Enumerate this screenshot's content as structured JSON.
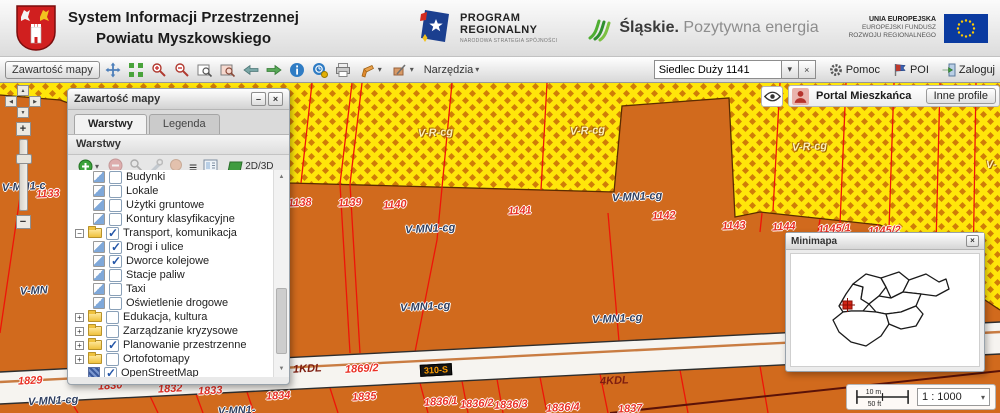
{
  "header": {
    "title_line1": "System Informacji Przestrzennej",
    "title_line2": "Powiatu Myszkowskiego",
    "program_logo": {
      "line1": "PROGRAM",
      "line2": "REGIONALNY",
      "subtitle": "NARODOWA STRATEGIA SPÓJNOŚCI"
    },
    "slaskie_logo": {
      "name": "Śląskie.",
      "tagline": "Pozytywna energia"
    },
    "eu_logo": {
      "line1": "UNIA EUROPEJSKA",
      "line2": "EUROPEJSKI FUNDUSZ",
      "line3": "ROZWOJU REGIONALNEGO"
    }
  },
  "toolbar": {
    "content_button": "Zawartość mapy",
    "tools_menu": "Narzędzia",
    "search_value": "Siedlec Duży 1141",
    "help_label": "Pomoc",
    "poi_label": "POI",
    "login_label": "Zaloguj"
  },
  "layers_panel": {
    "title": "Zawartość mapy",
    "tab_layers": "Warstwy",
    "tab_legend": "Legenda",
    "section_title": "Warstwy",
    "mode_label": "2D/3D",
    "tree": [
      {
        "label": "Budynki",
        "type": "layer",
        "checked": false,
        "indent": 1
      },
      {
        "label": "Lokale",
        "type": "layer",
        "checked": false,
        "indent": 1
      },
      {
        "label": "Użytki gruntowe",
        "type": "layer",
        "checked": false,
        "indent": 1
      },
      {
        "label": "Kontury klasyfikacyjne",
        "type": "layer",
        "checked": false,
        "indent": 1
      },
      {
        "label": "Transport, komunikacja",
        "type": "folder",
        "checked": true,
        "expanded": true,
        "indent": 0
      },
      {
        "label": "Drogi i ulice",
        "type": "layer",
        "checked": true,
        "indent": 1
      },
      {
        "label": "Dworce kolejowe",
        "type": "layer",
        "checked": true,
        "indent": 1
      },
      {
        "label": "Stacje paliw",
        "type": "layer",
        "checked": false,
        "indent": 1
      },
      {
        "label": "Taxi",
        "type": "layer",
        "checked": false,
        "indent": 1
      },
      {
        "label": "Oświetlenie drogowe",
        "type": "layer",
        "checked": false,
        "indent": 1
      },
      {
        "label": "Edukacja, kultura",
        "type": "folder",
        "checked": false,
        "expanded": false,
        "indent": 0
      },
      {
        "label": "Zarządzanie kryzysowe",
        "type": "folder",
        "checked": false,
        "expanded": false,
        "indent": 0
      },
      {
        "label": "Planowanie przestrzenne",
        "type": "folder",
        "checked": true,
        "expanded": false,
        "indent": 0
      },
      {
        "label": "Ortofotomapy",
        "type": "folder",
        "checked": false,
        "expanded": false,
        "indent": 0
      },
      {
        "label": "OpenStreetMap",
        "type": "osm",
        "checked": true,
        "indent": 0
      }
    ]
  },
  "profile_bar": {
    "portal": "Portal Mieszkańca",
    "other_profiles": "Inne profile"
  },
  "minimap": {
    "title": "Minimapa"
  },
  "scale": {
    "bar_m": "10 m",
    "bar_ft": "50 ft",
    "ratio": "1 : 1000"
  },
  "map": {
    "labels": [
      {
        "text": "V-R-cg",
        "x": 418,
        "y": 44,
        "cls": "zone-light"
      },
      {
        "text": "V-R-cg",
        "x": 570,
        "y": 42,
        "cls": "zone-light"
      },
      {
        "text": "V-R-cg",
        "x": 792,
        "y": 58,
        "cls": "zone-light"
      },
      {
        "text": "V-",
        "x": 986,
        "y": 76,
        "cls": "zone-light"
      },
      {
        "text": "V-MN1-cg",
        "x": 405,
        "y": 140,
        "cls": "zone-dark"
      },
      {
        "text": "V-MN1-cg",
        "x": 612,
        "y": 108,
        "cls": "zone-dark"
      },
      {
        "text": "V-MN1-cg",
        "x": 400,
        "y": 218,
        "cls": "zone-dark"
      },
      {
        "text": "V-MN1-cg",
        "x": 592,
        "y": 230,
        "cls": "zone-dark"
      },
      {
        "text": "V-MN1-cg",
        "x": 28,
        "y": 312,
        "cls": "zone-dark"
      },
      {
        "text": "V-MN1-c",
        "x": 2,
        "y": 98,
        "cls": "zone-dark"
      },
      {
        "text": "V-MN",
        "x": 20,
        "y": 202,
        "cls": "zone-dark"
      },
      {
        "text": "V-MN1-",
        "x": 218,
        "y": 322,
        "cls": "zone-dark"
      },
      {
        "text": "1133",
        "x": 36,
        "y": 105,
        "cls": "parcel"
      },
      {
        "text": "1138",
        "x": 288,
        "y": 114,
        "cls": "parcel"
      },
      {
        "text": "1139",
        "x": 338,
        "y": 114,
        "cls": "parcel"
      },
      {
        "text": "1140",
        "x": 383,
        "y": 116,
        "cls": "parcel"
      },
      {
        "text": "1141",
        "x": 508,
        "y": 122,
        "cls": "parcel"
      },
      {
        "text": "1142",
        "x": 652,
        "y": 127,
        "cls": "parcel"
      },
      {
        "text": "1143",
        "x": 722,
        "y": 137,
        "cls": "parcel"
      },
      {
        "text": "1144",
        "x": 772,
        "y": 138,
        "cls": "parcel"
      },
      {
        "text": "1145/1",
        "x": 818,
        "y": 140,
        "cls": "parcel"
      },
      {
        "text": "1145/2",
        "x": 868,
        "y": 142,
        "cls": "parcel"
      },
      {
        "text": "1829",
        "x": 18,
        "y": 292,
        "cls": "parcel"
      },
      {
        "text": "1830",
        "x": 98,
        "y": 297,
        "cls": "parcel"
      },
      {
        "text": "1832",
        "x": 158,
        "y": 300,
        "cls": "parcel"
      },
      {
        "text": "1833",
        "x": 198,
        "y": 302,
        "cls": "parcel"
      },
      {
        "text": "1834",
        "x": 266,
        "y": 307,
        "cls": "parcel"
      },
      {
        "text": "1835",
        "x": 352,
        "y": 308,
        "cls": "parcel"
      },
      {
        "text": "1836/1",
        "x": 424,
        "y": 313,
        "cls": "parcel"
      },
      {
        "text": "1836/2",
        "x": 460,
        "y": 315,
        "cls": "parcel"
      },
      {
        "text": "1836/3",
        "x": 494,
        "y": 316,
        "cls": "parcel"
      },
      {
        "text": "1836/4",
        "x": 546,
        "y": 319,
        "cls": "parcel"
      },
      {
        "text": "1837",
        "x": 618,
        "y": 320,
        "cls": "parcel"
      },
      {
        "text": "1869/2",
        "x": 345,
        "y": 280,
        "cls": "parcel"
      },
      {
        "text": "1KDL",
        "x": 293,
        "y": 280,
        "cls": "road"
      },
      {
        "text": "4KDL",
        "x": 600,
        "y": 292,
        "cls": "road"
      },
      {
        "text": "310-S",
        "x": 420,
        "y": 281,
        "cls": "badge"
      }
    ]
  }
}
